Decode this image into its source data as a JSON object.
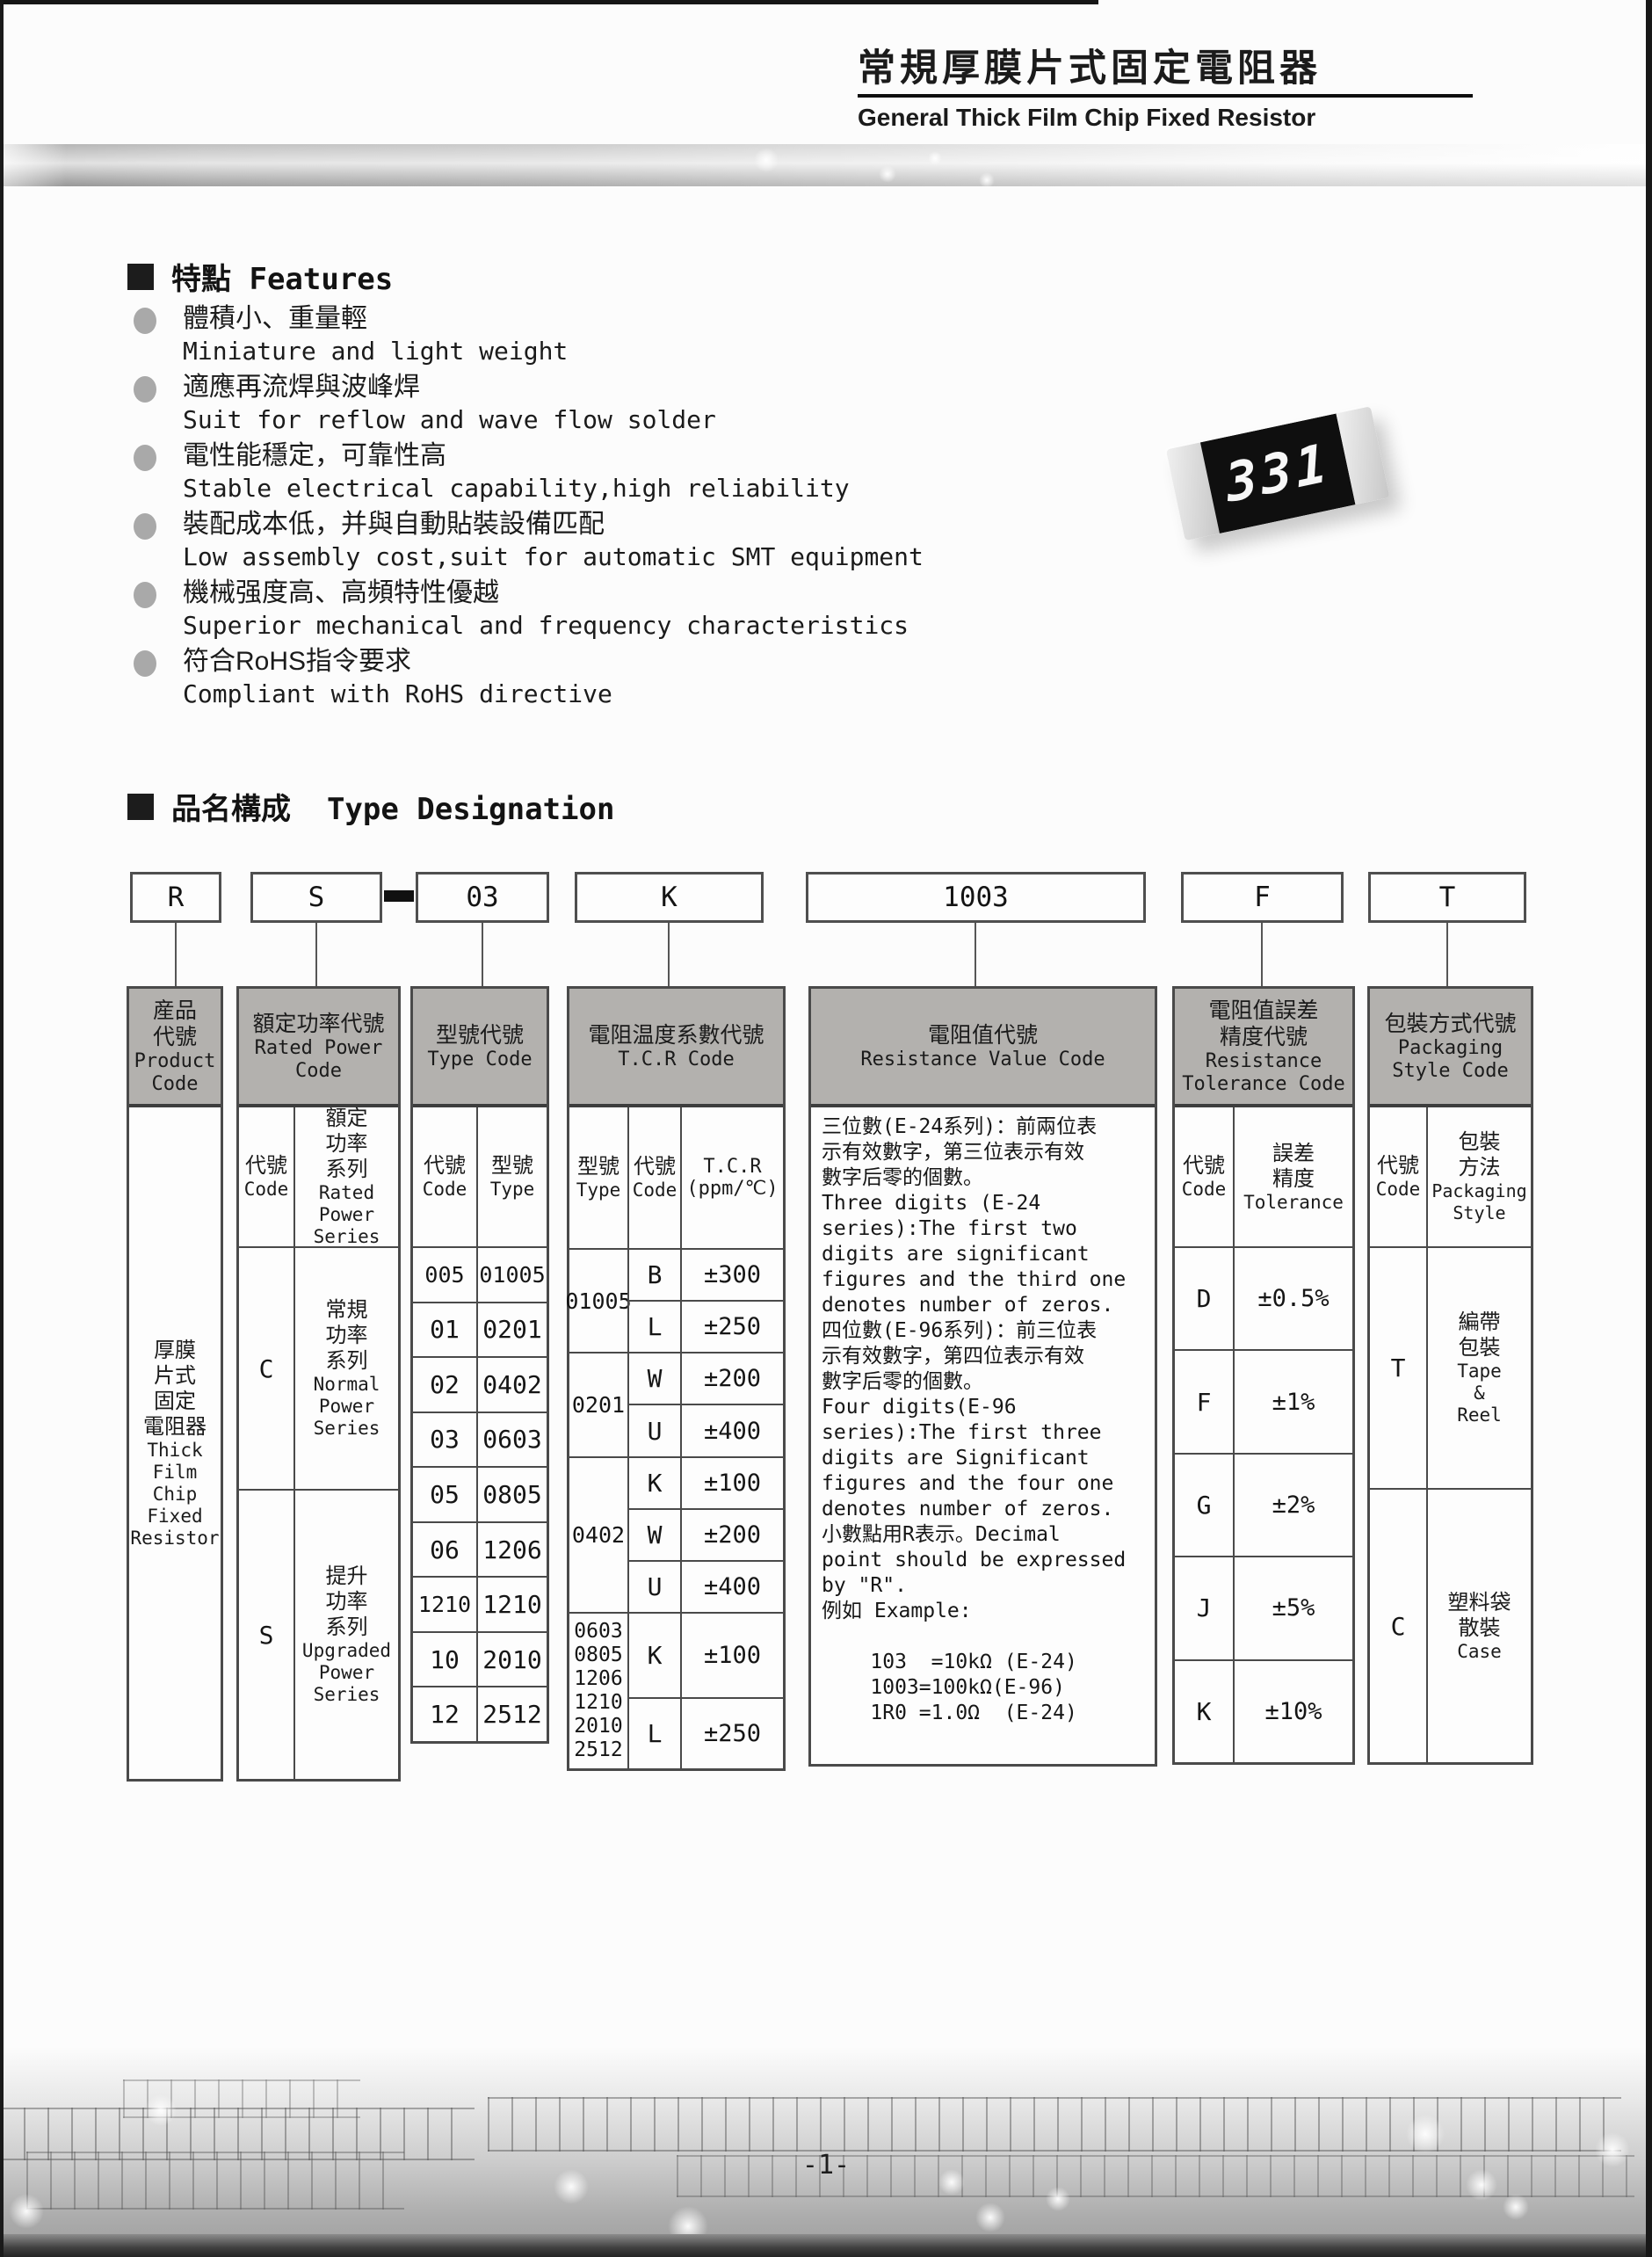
{
  "page": {
    "title_cn": "常規厚膜片式固定電阻器",
    "title_en": "General Thick Film Chip Fixed Resistor",
    "page_number": "-1-"
  },
  "chip_photo": {
    "marking": "331"
  },
  "features": {
    "heading": "特點 Features",
    "items": [
      {
        "cn": "體積小、重量輕",
        "en": "Miniature and light weight"
      },
      {
        "cn": "適應再流焊與波峰焊",
        "en": "Suit for reflow and wave flow solder"
      },
      {
        "cn": "電性能穩定，可靠性高",
        "en": "Stable electrical capability,high reliability"
      },
      {
        "cn": "裝配成本低，并與自動貼裝設備匹配",
        "en": "Low assembly cost,suit for automatic SMT equipment"
      },
      {
        "cn": "機械强度高、高頻特性優越",
        "en": "Superior mechanical and frequency characteristics"
      },
      {
        "cn": "符合RoHS指令要求",
        "en": "Compliant with RoHS directive"
      }
    ]
  },
  "designation": {
    "heading": "品名構成  Type Designation",
    "separator": "-",
    "codes": [
      "R",
      "S",
      "03",
      "K",
      "1003",
      "F",
      "T"
    ]
  },
  "table": {
    "product": {
      "header_cn": "産品\n代號",
      "header_en": "Product\nCode",
      "body_cn": "厚膜\n片式\n固定\n電阻器",
      "body_en": "Thick\nFilm\nChip\nFixed\nResistor"
    },
    "rated_power": {
      "header_cn": "額定功率代號",
      "header_en": "Rated Power\nCode",
      "sub_code_cn": "代號",
      "sub_code_en": "Code",
      "sub_series_cn": "額定\n功率\n系列",
      "sub_series_en": "Rated\nPower\nSeries",
      "rows": [
        {
          "code": "C",
          "cn": "常規\n功率\n系列",
          "en": "Normal\nPower\nSeries"
        },
        {
          "code": "S",
          "cn": "提升\n功率\n系列",
          "en": "Upgraded\nPower\nSeries"
        }
      ]
    },
    "type_code": {
      "header_cn": "型號代號",
      "header_en": "Type Code",
      "sub_code_cn": "代號",
      "sub_code_en": "Code",
      "sub_type_cn": "型號",
      "sub_type_en": "Type",
      "rows": [
        {
          "code": "005",
          "type": "01005"
        },
        {
          "code": "01",
          "type": "0201"
        },
        {
          "code": "02",
          "type": "0402"
        },
        {
          "code": "03",
          "type": "0603"
        },
        {
          "code": "05",
          "type": "0805"
        },
        {
          "code": "06",
          "type": "1206"
        },
        {
          "code": "1210",
          "type": "1210"
        },
        {
          "code": "10",
          "type": "2010"
        },
        {
          "code": "12",
          "type": "2512"
        }
      ]
    },
    "tcr": {
      "header_cn": "電阻温度系數代號",
      "header_en": "T.C.R Code",
      "sub_type_cn": "型號",
      "sub_type_en": "Type",
      "sub_code_cn": "代號",
      "sub_code_en": "Code",
      "sub_tcr": "T.C.R\n(ppm/℃)",
      "groups": [
        {
          "type": "01005",
          "rows": [
            {
              "code": "B",
              "val": "±300"
            },
            {
              "code": "L",
              "val": "±250"
            }
          ]
        },
        {
          "type": "0201",
          "rows": [
            {
              "code": "W",
              "val": "±200"
            },
            {
              "code": "U",
              "val": "±400"
            }
          ]
        },
        {
          "type": "0402",
          "rows": [
            {
              "code": "K",
              "val": "±100"
            },
            {
              "code": "W",
              "val": "±200"
            },
            {
              "code": "U",
              "val": "±400"
            }
          ]
        },
        {
          "type": "0603\n0805\n1206\n1210\n2010\n2512",
          "rows": [
            {
              "code": "K",
              "val": "±100"
            },
            {
              "code": "L",
              "val": "±250"
            }
          ]
        }
      ]
    },
    "resistance_value": {
      "header_cn": "電阻值代號",
      "header_en": "Resistance Value Code",
      "body": "三位數(E-24系列)：前兩位表\n示有效數字，第三位表示有效\n數字后零的個數。\nThree digits (E-24\nseries):The first two\ndigits are significant\nfigures and the third one\ndenotes number of zeros.\n四位數(E-96系列)：前三位表\n示有效數字，第四位表示有效\n數字后零的個數。\nFour digits(E-96\nseries):The first three\ndigits are Significant\nfigures and the four one\ndenotes number of zeros.\n小數點用R表示。Decimal\npoint should be expressed\nby \"R\".\n例如 Example:\n\n    103  =10kΩ (E-24)\n    1003=100kΩ(E-96)\n    1R0 =1.0Ω  (E-24)"
    },
    "tolerance": {
      "header_cn": "電阻值誤差\n精度代號",
      "header_en": "Resistance\nTolerance Code",
      "sub_code_cn": "代號",
      "sub_code_en": "Code",
      "sub_tol_cn": "誤差\n精度",
      "sub_tol_en": "Tolerance",
      "rows": [
        {
          "code": "D",
          "val": "±0.5%"
        },
        {
          "code": "F",
          "val": "±1%"
        },
        {
          "code": "G",
          "val": "±2%"
        },
        {
          "code": "J",
          "val": "±5%"
        },
        {
          "code": "K",
          "val": "±10%"
        }
      ]
    },
    "packaging": {
      "header_cn": "包裝方式代號",
      "header_en": "Packaging\nStyle Code",
      "sub_code_cn": "代號",
      "sub_code_en": "Code",
      "sub_style_cn": "包裝\n方法",
      "sub_style_en": "Packaging\nStyle",
      "rows": [
        {
          "code": "T",
          "cn": "編帶\n包裝",
          "en": "Tape\n&\nReel"
        },
        {
          "code": "C",
          "cn": "塑料袋\n散裝",
          "en": "Case"
        }
      ]
    }
  }
}
